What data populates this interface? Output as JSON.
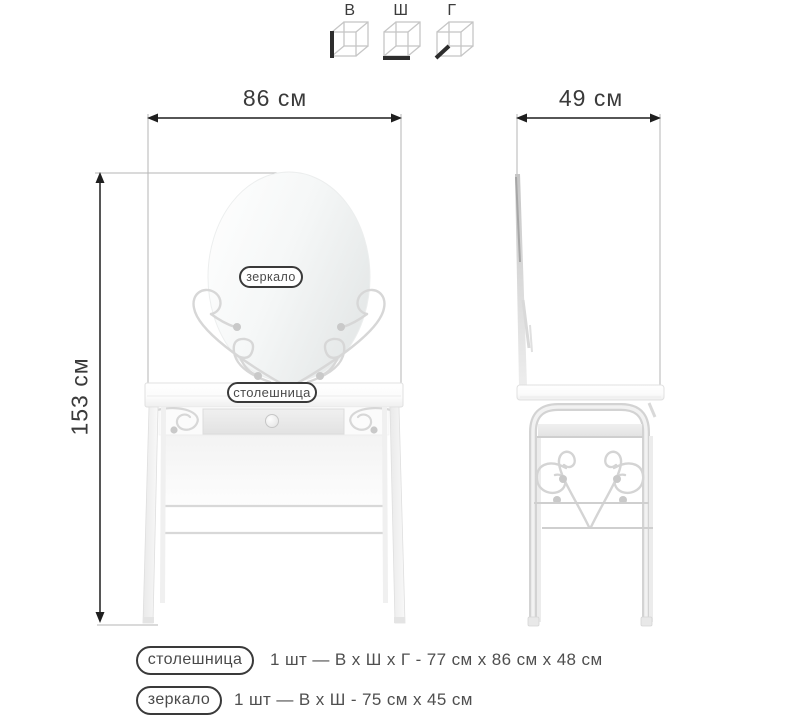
{
  "window": {
    "background": "#ffffff",
    "description": "Dressing table with oval mirror - dimension drawing, front and side views"
  },
  "dimension_legend": {
    "items": [
      {
        "id": "height",
        "label": "В",
        "icon": "cube-height-edge-icon"
      },
      {
        "id": "width",
        "label": "Ш",
        "icon": "cube-width-edge-icon"
      },
      {
        "id": "depth",
        "label": "Г",
        "icon": "cube-depth-edge-icon"
      }
    ]
  },
  "front_view": {
    "width_dimension": "86 см",
    "height_dimension": "153 см",
    "mirror_tag": "зеркало",
    "tabletop_tag": "столешница"
  },
  "side_view": {
    "depth_dimension": "49 см"
  },
  "specs": [
    {
      "tag": "столешница",
      "details": "1 шт — В х Ш х Г - 77 см х 86 см х 48 см"
    },
    {
      "tag": "зеркало",
      "details": "1 шт — В х Ш - 75 см х 45 см"
    }
  ],
  "colors": {
    "dimension_arrow": "#1f1f1f",
    "extension_line": "#b5b5b5",
    "furniture_outline": "#dddddd",
    "ornament": "#d7d7d7",
    "pill_border": "#3a3a3a",
    "text": "#4a4a4a"
  }
}
